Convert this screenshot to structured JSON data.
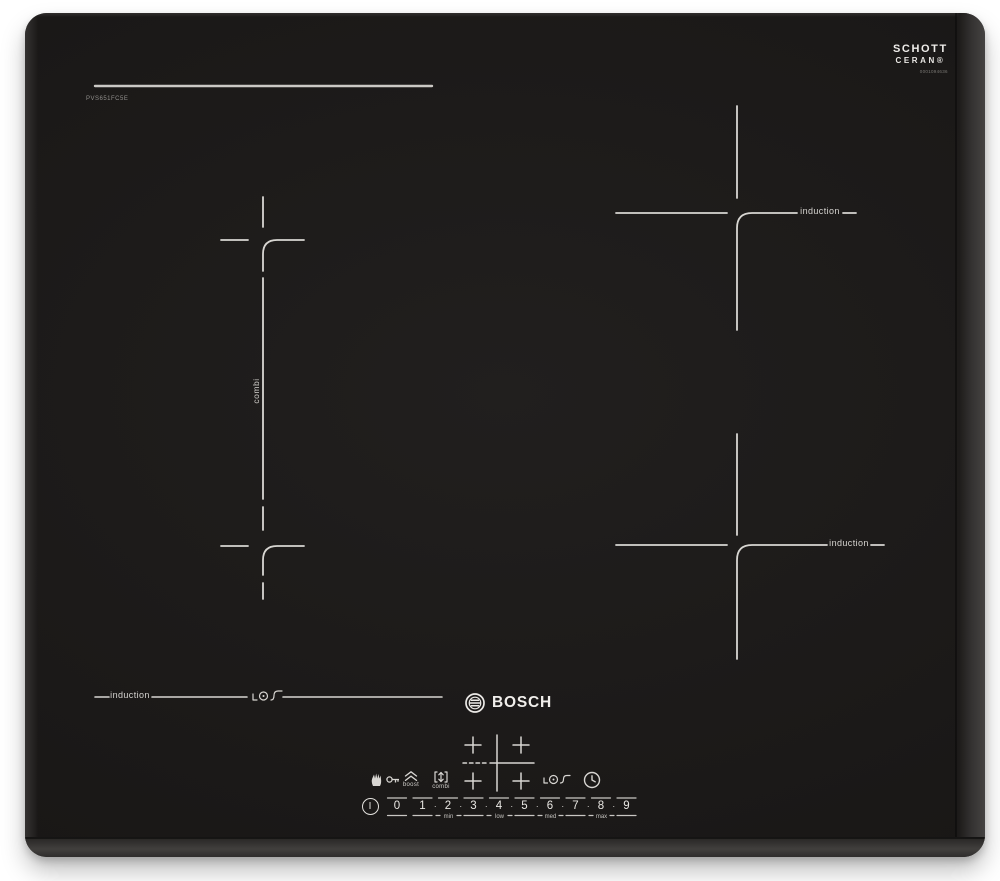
{
  "device": {
    "brand_logo_text": "BOSCH",
    "model_number": "PVS651FC5E",
    "glass_brand": {
      "line1": "SCHOTT",
      "line2": "CERAN®",
      "serial": "0001094636"
    }
  },
  "zone_labels": {
    "combi": "combi",
    "induction_back_right": "induction",
    "induction_front_right": "induction",
    "induction_front_left": "induction"
  },
  "control_panel": {
    "buttons": {
      "boost": {
        "label": "boost"
      },
      "combi": {
        "label": "combi"
      }
    },
    "power_slider": {
      "power_symbol": "I",
      "numbers": [
        "0",
        "1",
        "2",
        "3",
        "4",
        "5",
        "6",
        "7",
        "8",
        "9"
      ],
      "separator_dot": "·",
      "level_labels": [
        {
          "text": "min",
          "under": "2"
        },
        {
          "text": "low",
          "under": "4"
        },
        {
          "text": "med",
          "under": "6"
        },
        {
          "text": "max",
          "under": "8"
        }
      ]
    }
  },
  "icons": {
    "glass_logo": "schott-ceran-logo",
    "brand_emblem": "bosch-armature-icon",
    "wipe_lock": "hand-and-key-icon",
    "boost": "double-chevron-up-icon",
    "combi": "merge-arrows-icon",
    "fry_sensor": "pan-sensor-icon",
    "timer": "clock-icon",
    "power": "power-circle-icon"
  },
  "colors": {
    "glass": "#1b1918",
    "markings": "#d8d6d2",
    "frame_bevel": "#3d3b3a",
    "background": "#ffffff"
  }
}
